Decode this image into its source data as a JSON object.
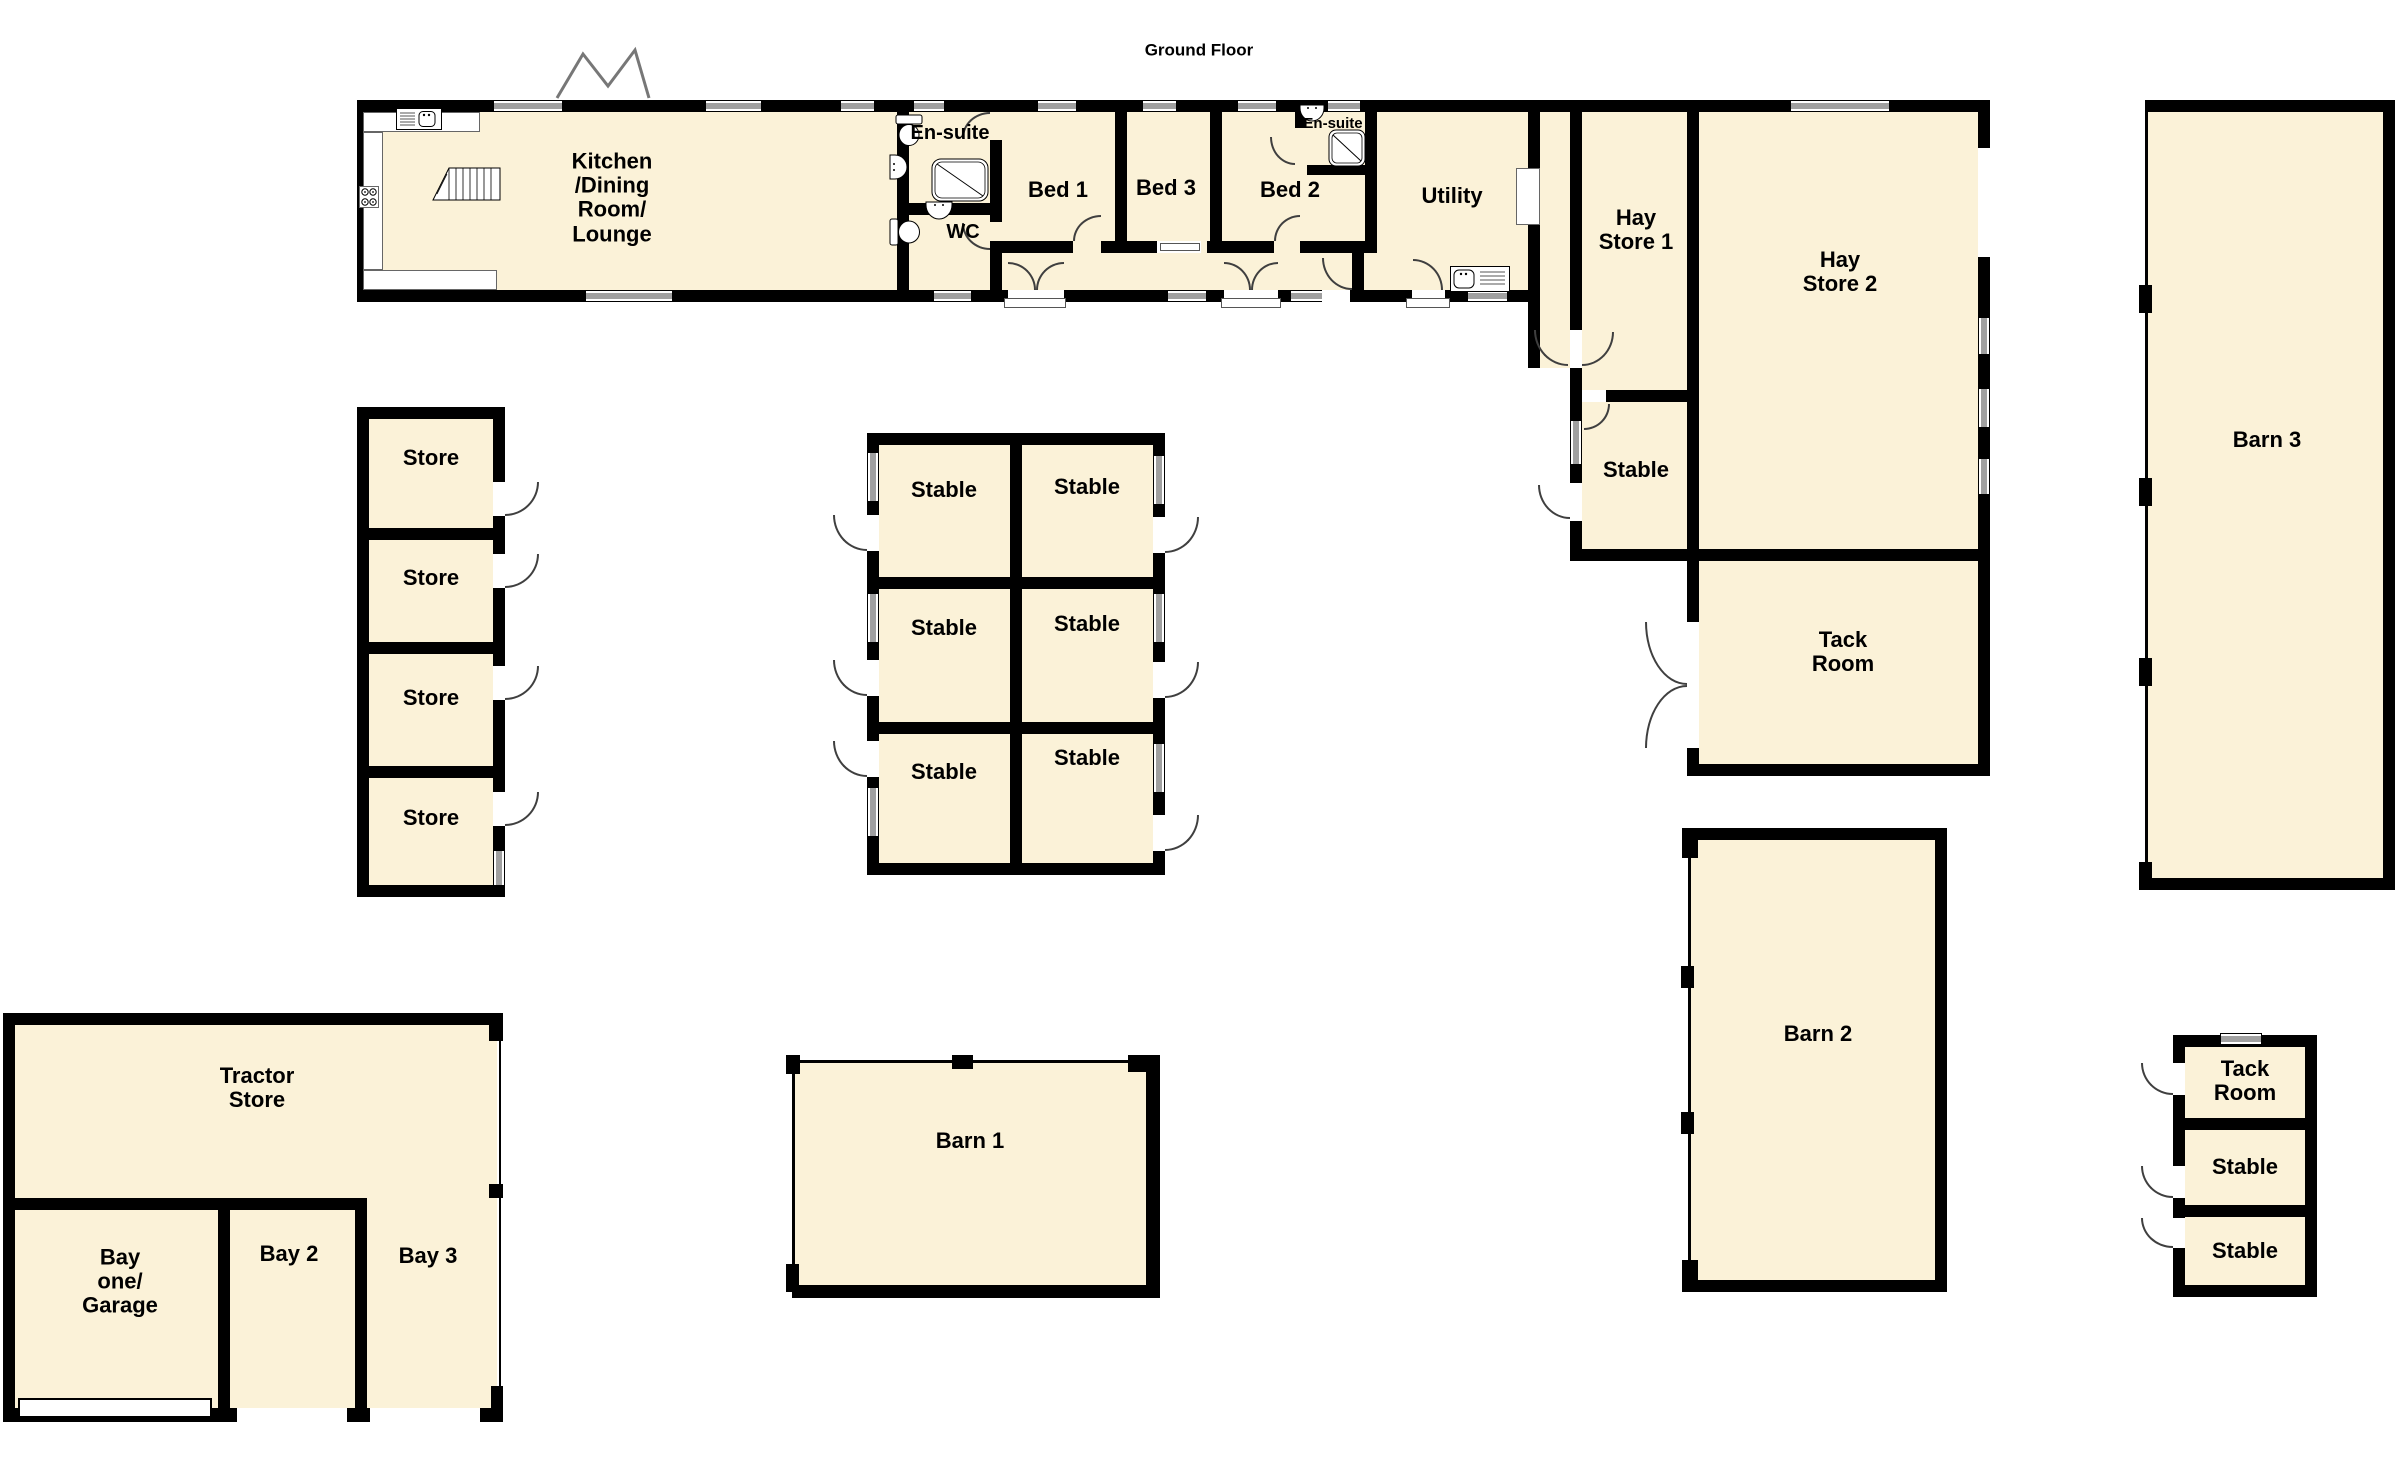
{
  "title": "Ground Floor",
  "colors": {
    "floor_fill": "#FBF2D8",
    "wall": "#000000",
    "window_gray": "#A0A0A0",
    "door_arc": "#3F3F3F"
  },
  "icons": {
    "kitchen_sink": "kitchen-sink-icon",
    "hob": "hob-icon",
    "stairs": "stairs-icon",
    "toilet": "toilet-icon",
    "basin": "basin-icon",
    "shower": "shower-icon",
    "utility_sink": "utility-sink-icon",
    "window": "window-marker",
    "door": "door-swing-arc",
    "garage_door": "garage-door-panel",
    "wall_break": "wall-break-zigzag"
  },
  "main_house": {
    "kitchen": "Kitchen\n/Dining\nRoom/\nLounge",
    "ensuite_1": "En-suite",
    "wc": "WC",
    "bed_1": "Bed 1",
    "bed_3": "Bed 3",
    "bed_2": "Bed 2",
    "ensuite_2": "En-suite",
    "utility": "Utility"
  },
  "hay_block": {
    "hay_store_1": "Hay\nStore 1",
    "hay_store_2": "Hay\nStore 2",
    "stable": "Stable",
    "tack_room": "Tack\nRoom"
  },
  "store_block": {
    "stores": [
      "Store",
      "Store",
      "Store",
      "Store"
    ]
  },
  "stable_block": {
    "stables": [
      "Stable",
      "Stable",
      "Stable",
      "Stable",
      "Stable",
      "Stable"
    ]
  },
  "barns": {
    "barn_1": "Barn 1",
    "barn_2": "Barn 2",
    "barn_3": "Barn 3"
  },
  "tractor_block": {
    "tractor_store": "Tractor\nStore",
    "bay_one": "Bay\none/\nGarage",
    "bay_2": "Bay 2",
    "bay_3": "Bay 3"
  },
  "small_block": {
    "tack_room": "Tack\nRoom",
    "stables": [
      "Stable",
      "Stable"
    ]
  }
}
